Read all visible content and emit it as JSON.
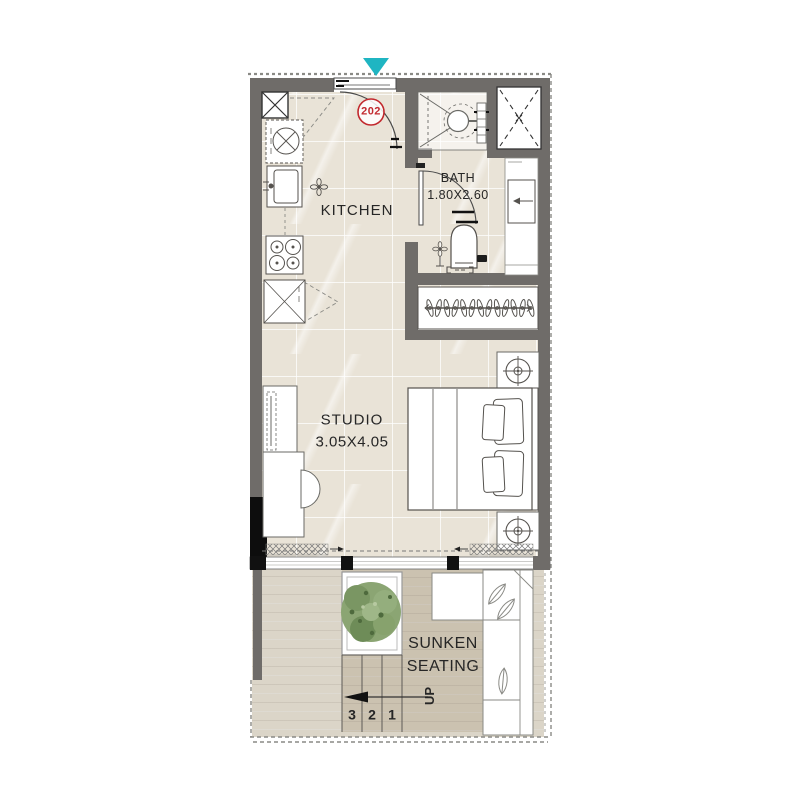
{
  "unit": {
    "number": "202"
  },
  "rooms": {
    "kitchen": {
      "label": "KITCHEN"
    },
    "bath": {
      "label": "BATH",
      "dimensions": "1.80X2.60"
    },
    "studio": {
      "label": "STUDIO",
      "dimensions": "3.05X4.05"
    },
    "sunken_seating": {
      "label_line1": "SUNKEN",
      "label_line2": "SEATING"
    }
  },
  "stairs": {
    "step_numbers": [
      "3",
      "2",
      "1"
    ],
    "direction_label": "UP"
  },
  "colors": {
    "wall": "#6f6c69",
    "tile": "#e9e3d7",
    "wood": "#dbd5c8",
    "sunken_floor": "#cbc2b0",
    "accent_teal": "#1fb5c2",
    "unit_red": "#c2292e",
    "line": "#55524e",
    "tree_green": "#86a06c",
    "column_black": "#0d0d0d"
  }
}
